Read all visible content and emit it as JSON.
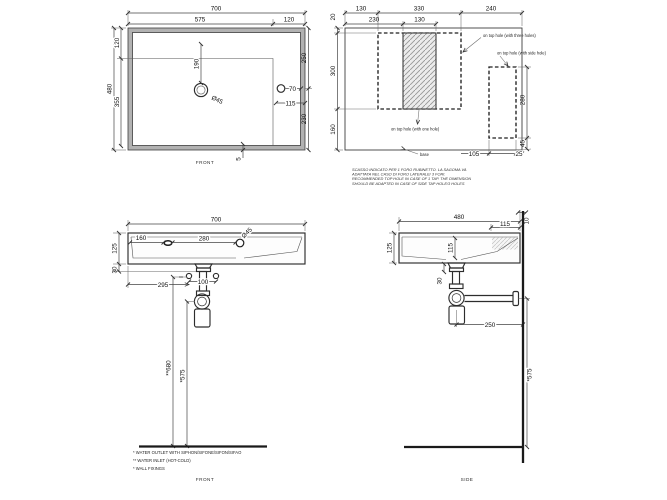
{
  "drawing": {
    "plan": {
      "dims": {
        "overall_width": "700",
        "bowl_width": "575",
        "right_shelf": "120",
        "top_edge": "120",
        "overall_depth": "480",
        "bowl_depth": "355",
        "drain_from_top": "190",
        "drain_diameter": "Ø45",
        "tap_hole_offset": "70",
        "tap_hole_inset": "115",
        "right_upper": "250",
        "right_lower": "230",
        "front_lip": "5"
      },
      "label": "FRONT"
    },
    "base_plan": {
      "dims": {
        "left_margin": "130",
        "cutout_width": "330",
        "right_margin": "240",
        "one_hole_offset": "230",
        "one_hole_width": "130",
        "top_gap": "20",
        "cutout_depth": "300",
        "bottom_gap": "160",
        "side_cutout_depth": "280",
        "side_cutout_bottom": "45",
        "side_cutout_width": "105",
        "side_cutout_margin": "25"
      },
      "notes": {
        "three_holes": "on top hole (with three holes)",
        "side_hole": "on top hole (with side hole)",
        "one_hole": "on top hole (with one hole)",
        "base": "base"
      },
      "note_block": [
        "SCASSO INDICATO PER 1 FORO RUBINETTO. LA SAGOMA VA",
        "ADATTATA NEL CASO DI FORO LATERALE/ 3 FORI.",
        "RECOMMENDED TOP HOLE IN CASE OF 1 TAP. THE DIMENSION",
        "SHOULD BE ADAPTED IN CASE OF SIDE TAP HOLE/3 HOLES"
      ]
    },
    "front_elevation": {
      "dims": {
        "overall_width": "700",
        "height": "125",
        "tailpiece": "30",
        "hole_from_left": "160",
        "holes_spacing": "280",
        "drain_diameter": "Ø45",
        "drain_from_left": "295",
        "inlet_spacing": "100",
        "inlet_marks": "**",
        "inlet_height": "**680",
        "outlet_height": "*575"
      },
      "label": "FRONT",
      "footnotes": [
        "* WATER OUTLET WITH SIPHON/SIFONE/SIFON/SIFAO",
        "** WATER INLET  (HOT-COLD)",
        "* WALL FIXINGS"
      ]
    },
    "side_elevation": {
      "dims": {
        "overall_depth": "480",
        "shelf_depth": "115",
        "wall_gap": "10",
        "height": "125",
        "bowl_depth": "115",
        "tailpiece": "30",
        "trap_to_wall": "250",
        "outlet_height": "*575"
      },
      "label": "SIDE"
    }
  }
}
